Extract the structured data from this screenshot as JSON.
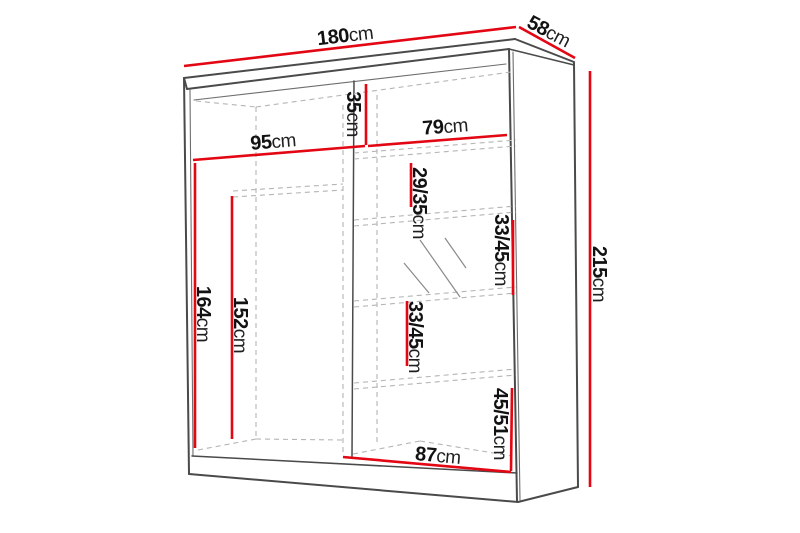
{
  "diagram": {
    "title": "wardrobe-dimension-diagram",
    "unit": "cm",
    "colors": {
      "dimension": "#e30613",
      "outline": "#4a4a4a",
      "outline_light": "#6e6e6e",
      "hidden": "#b5b5b5",
      "mirror": "#8a8a8a"
    },
    "labels": {
      "width": {
        "value": "180",
        "unit": "cm"
      },
      "depth": {
        "value": "58",
        "unit": "cm"
      },
      "height": {
        "value": "215",
        "unit": "cm"
      },
      "top_left_width": {
        "value": "95",
        "unit": "cm"
      },
      "top_shelf_height": {
        "value": "35",
        "unit": "cm"
      },
      "top_right_width": {
        "value": "79",
        "unit": "cm"
      },
      "shelf_space_1": {
        "value": "29/35",
        "unit": "cm"
      },
      "shelf_space_2": {
        "value": "33/45",
        "unit": "cm"
      },
      "shelf_space_3": {
        "value": "33/45",
        "unit": "cm"
      },
      "bottom_space": {
        "value": "45/51",
        "unit": "cm"
      },
      "door_height": {
        "value": "164",
        "unit": "cm"
      },
      "interior_height": {
        "value": "152",
        "unit": "cm"
      },
      "bottom_right_width": {
        "value": "87",
        "unit": "cm"
      }
    }
  }
}
